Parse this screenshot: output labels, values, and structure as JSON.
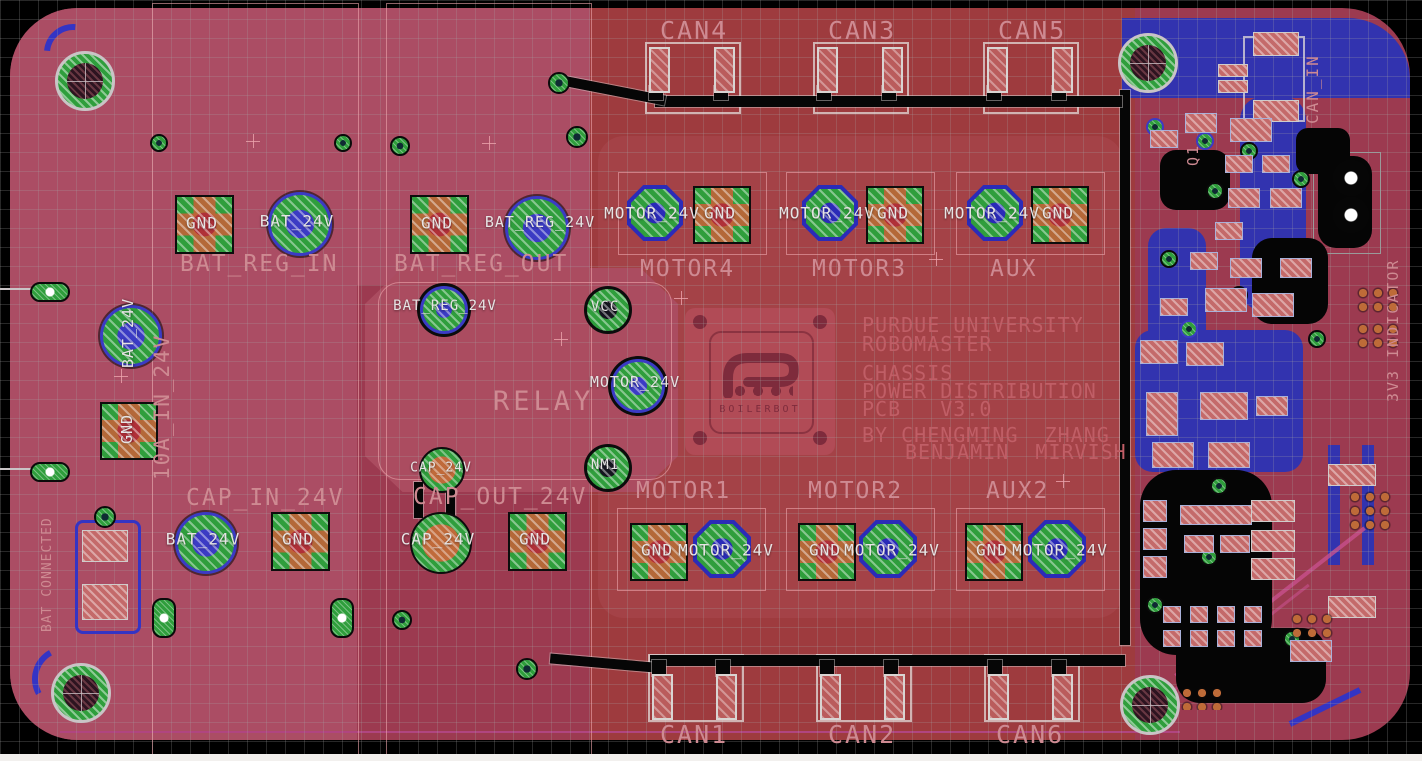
{
  "connectors": {
    "can_top": [
      {
        "label": "CAN4"
      },
      {
        "label": "CAN3"
      },
      {
        "label": "CAN5"
      }
    ],
    "can_bottom": [
      {
        "label": "CAN1"
      },
      {
        "label": "CAN2"
      },
      {
        "label": "CAN6"
      }
    ],
    "can_in_label": "CAN_IN",
    "motor_top": [
      {
        "label": "MOTOR4"
      },
      {
        "label": "MOTOR3"
      },
      {
        "label": "AUX"
      }
    ],
    "motor_bottom": [
      {
        "label": "MOTOR1"
      },
      {
        "label": "MOTOR2"
      },
      {
        "label": "AUX2"
      }
    ],
    "pad_motor_24v": "MOTOR_24V",
    "pad_gnd": "GND"
  },
  "power_groups": {
    "bat_reg_in": {
      "label": "BAT_REG_IN",
      "pads": [
        "GND",
        "BAT_24V"
      ]
    },
    "bat_reg_out": {
      "label": "BAT_REG_OUT",
      "pads": [
        "GND",
        "BAT_REG_24V"
      ]
    },
    "input_10a": {
      "label": "10A_IN_24V",
      "pads": [
        "BAT_24V",
        "GND"
      ]
    },
    "cap_in": {
      "label": "CAP_IN_24V",
      "pads": [
        "BAT_24V",
        "GND"
      ]
    },
    "cap_out": {
      "label": "CAP_OUT_24V",
      "pads": [
        "CAP_24V",
        "GND"
      ]
    }
  },
  "relay": {
    "label": "RELAY",
    "pads": {
      "bat_reg": "BAT_REG_24V",
      "vcc": "VCC",
      "motor": "MOTOR_24V",
      "cap": "CAP_24V",
      "nm": "NM1"
    }
  },
  "silkscreen": {
    "bat_connected": "BAT CONNECTED",
    "indicator_3v3": "3V3 INDICATOR",
    "q1": "Q1"
  },
  "title_block": {
    "lines": [
      "PURDUE UNIVERSITY",
      "ROBOMASTER",
      "CHASSIS",
      "POWER DISTRIBUTION",
      "PCB   V3.0",
      "BY CHENGMING  ZHANG",
      "BENJAMIN  MIRVISH"
    ]
  },
  "logo": {
    "wordmark": "BOILERBOT"
  },
  "colors": {
    "board": "#9C3A50",
    "zone_light": "#AB4D64",
    "zone_red": "#9E3B3E",
    "copper_blue": "#3233AF",
    "pad_green": "#2F9E3C",
    "silk": "#CE8A92",
    "pad_text": "#E6E4E4"
  }
}
